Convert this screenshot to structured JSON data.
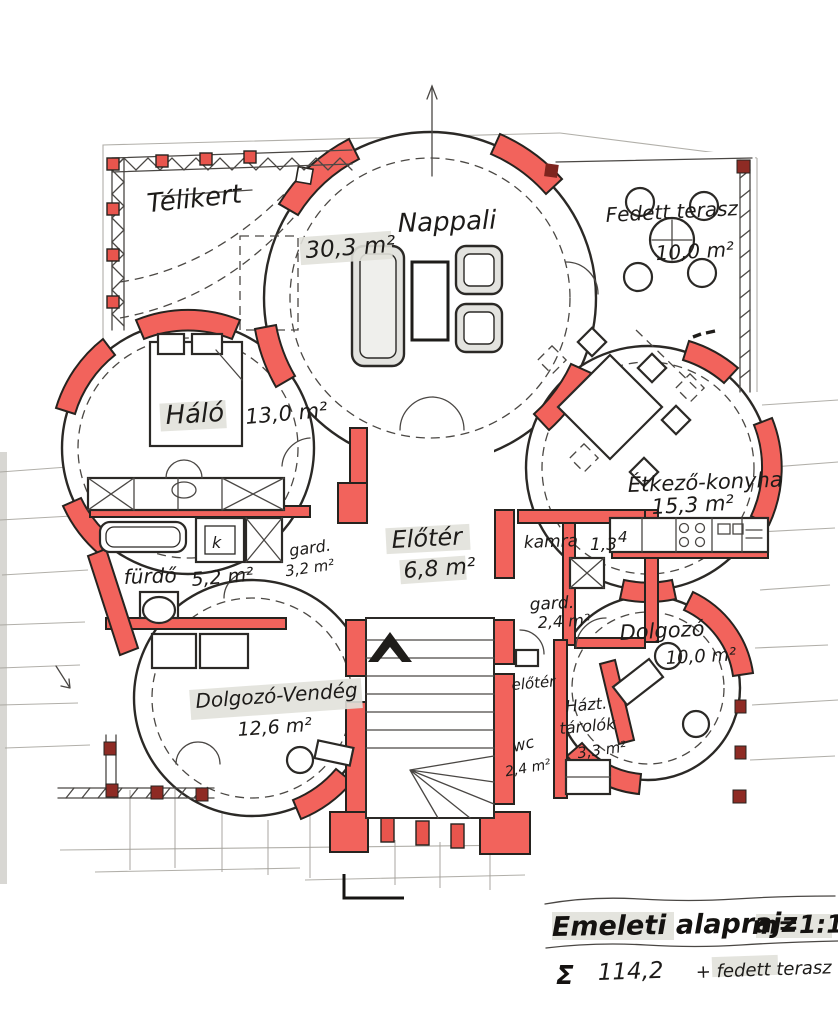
{
  "plan": {
    "rooms": [
      {
        "name": "telikert",
        "label": "Télikert",
        "area": ""
      },
      {
        "name": "nappali",
        "label": "Nappali",
        "area": "30,3 m²"
      },
      {
        "name": "fedett-terasz",
        "label": "Fedett terasz",
        "area": "10,0 m²"
      },
      {
        "name": "halo",
        "label": "Háló",
        "area": "13,0 m²"
      },
      {
        "name": "etkezo-konyha",
        "label": "Étkező-konyha",
        "area": "15,3 m²"
      },
      {
        "name": "eloter",
        "label": "Előtér",
        "area": "6,8 m²"
      },
      {
        "name": "kamra",
        "label": "kamra",
        "area": "1,3"
      },
      {
        "name": "gardrob-1",
        "label": "gard.",
        "area": "3,2 m²"
      },
      {
        "name": "gardrob-2",
        "label": "gard.",
        "area": "2,4 m²"
      },
      {
        "name": "furdo",
        "label": "fürdő",
        "area": "5,2 m²"
      },
      {
        "name": "wc",
        "label": "wc",
        "area": "2,4 m²"
      },
      {
        "name": "eloter-kis",
        "label": "előtér",
        "area": ""
      },
      {
        "name": "haztartasi-tarolok",
        "label": "Házt.",
        "label2": "tárolók",
        "area": "3,3 m²"
      },
      {
        "name": "dolgozo",
        "label": "Dolgozó",
        "area": "10,0 m²"
      },
      {
        "name": "dolgozo-vendeg",
        "label": "Dolgozó-Vendég",
        "area": "12,6 m²"
      }
    ],
    "annotations": {
      "closet_k": "k",
      "counter_mark": "4"
    },
    "title_block": {
      "title": "Emeleti alaprajz",
      "scale": "m=1:100",
      "sigma": "Σ",
      "total_area": "114,2",
      "total_suffix": "+ fedett terasz"
    },
    "colors": {
      "wall_red": "#f2635c",
      "ink": "#2b2926",
      "paper": "#ffffff",
      "furniture_gray": "#e3e3df",
      "highlight_gray": "#e1e1da"
    }
  }
}
